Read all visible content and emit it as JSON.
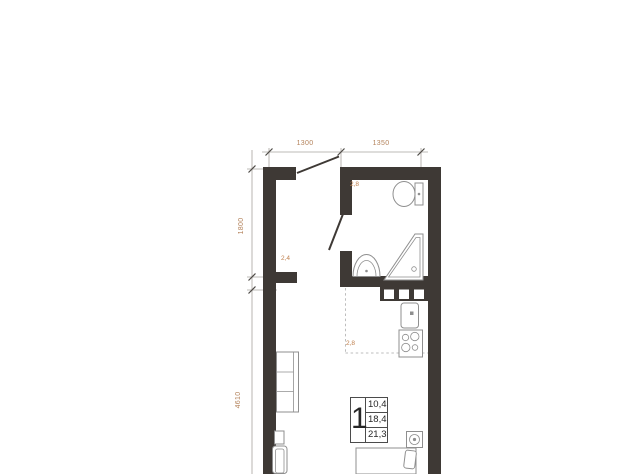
{
  "plan": {
    "type": "apartment-floor-plan",
    "dimensions_top": [
      "1300",
      "1350"
    ],
    "dimensions_left": [
      "1800",
      "4610"
    ],
    "areas": {
      "bathroom": "2,8",
      "hallway": "2,4",
      "kitchen": "2,8"
    },
    "info_box": {
      "rooms_count": "1",
      "values": [
        "10,4",
        "18,4",
        "21,3"
      ]
    },
    "fixtures": [
      "toilet-icon",
      "shower-icon",
      "washbasin-icon",
      "kitchen-sink-icon",
      "stove-icon",
      "kitchen-cabinets-icon",
      "wardrobe-icon",
      "hall-cabinet-icon",
      "bed-icon",
      "pillow-icon",
      "nightstand-icon",
      "entrance-door-icon",
      "bathroom-door-icon"
    ],
    "colors": {
      "wall": "#3e3935",
      "dim_line": "#a8a49f",
      "dim_text": "#b4835c",
      "area_label": "#bf7f4c",
      "outline": "#8f8f8f"
    }
  }
}
